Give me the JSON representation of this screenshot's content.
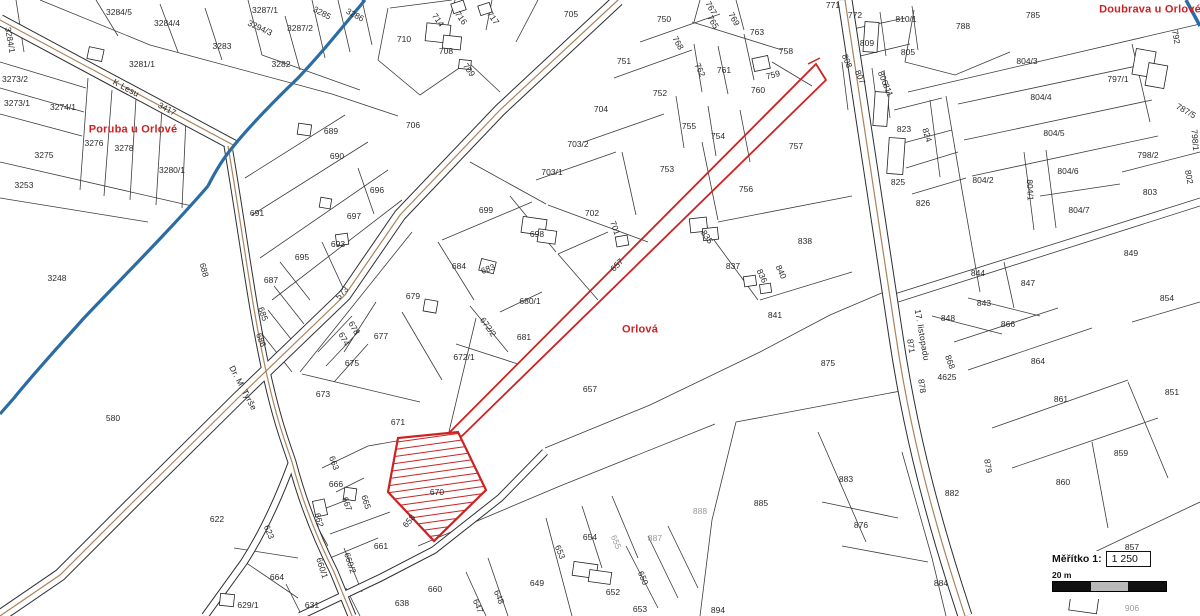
{
  "map": {
    "title": "cadastral-map",
    "highlight": {
      "hatched_parcel": "670",
      "color": "#cc2222"
    },
    "colors": {
      "parcel_line": "#3c3c3c",
      "stream": "#2b6ca3",
      "road_center": "#a9835c",
      "highlight": "#cc2222",
      "area_label": "#cc2222",
      "scale_bar_gray": "#b9b9b9"
    },
    "scale": {
      "label": "Měřítko  1:",
      "ratio": "1 250",
      "bar_label": "20 m"
    },
    "labels": [
      {
        "t": "Poruba u Orlové",
        "x": 133,
        "y": 130,
        "cls": "area"
      },
      {
        "t": "Orlová",
        "x": 640,
        "y": 330,
        "cls": "area"
      },
      {
        "t": "Doubrava u Orlové",
        "x": 1150,
        "y": 10,
        "cls": "area"
      },
      {
        "t": "K Lesu",
        "x": 126,
        "y": 88,
        "r": 28,
        "cls": "street"
      },
      {
        "t": "Dr. M. Tyrše",
        "x": 243,
        "y": 388,
        "r": 62,
        "cls": "street"
      },
      {
        "t": "17. listopadu",
        "x": 922,
        "y": 335,
        "r": 80,
        "cls": "street"
      },
      {
        "t": "3284/1",
        "x": 10,
        "y": 40,
        "r": 80
      },
      {
        "t": "3284/5",
        "x": 119,
        "y": 12
      },
      {
        "t": "3284/4",
        "x": 167,
        "y": 23
      },
      {
        "t": "3287/1",
        "x": 265,
        "y": 10
      },
      {
        "t": "3294/3",
        "x": 260,
        "y": 28,
        "r": 25
      },
      {
        "t": "3283",
        "x": 222,
        "y": 46
      },
      {
        "t": "3287/2",
        "x": 300,
        "y": 28
      },
      {
        "t": "3285",
        "x": 322,
        "y": 13,
        "r": 28
      },
      {
        "t": "3286",
        "x": 355,
        "y": 15,
        "r": 28
      },
      {
        "t": "3282",
        "x": 281,
        "y": 64
      },
      {
        "t": "3281/1",
        "x": 142,
        "y": 64
      },
      {
        "t": "3417",
        "x": 167,
        "y": 109,
        "r": 28
      },
      {
        "t": "3273/2",
        "x": 15,
        "y": 79
      },
      {
        "t": "3273/1",
        "x": 17,
        "y": 103
      },
      {
        "t": "3274/1",
        "x": 63,
        "y": 107
      },
      {
        "t": "3276",
        "x": 94,
        "y": 143
      },
      {
        "t": "3278",
        "x": 124,
        "y": 148
      },
      {
        "t": "3275",
        "x": 44,
        "y": 155
      },
      {
        "t": "3280/1",
        "x": 172,
        "y": 170
      },
      {
        "t": "3253",
        "x": 24,
        "y": 185
      },
      {
        "t": "3248",
        "x": 57,
        "y": 278
      },
      {
        "t": "580",
        "x": 113,
        "y": 418
      },
      {
        "t": "622",
        "x": 217,
        "y": 519
      },
      {
        "t": "691",
        "x": 257,
        "y": 213
      },
      {
        "t": "687",
        "x": 271,
        "y": 280
      },
      {
        "t": "685",
        "x": 263,
        "y": 314,
        "r": 70
      },
      {
        "t": "686",
        "x": 261,
        "y": 340,
        "r": 70
      },
      {
        "t": "688",
        "x": 204,
        "y": 270,
        "r": 75
      },
      {
        "t": "623",
        "x": 269,
        "y": 532,
        "r": 68
      },
      {
        "t": "689",
        "x": 331,
        "y": 131
      },
      {
        "t": "690",
        "x": 337,
        "y": 156
      },
      {
        "t": "696",
        "x": 377,
        "y": 190
      },
      {
        "t": "697",
        "x": 354,
        "y": 216
      },
      {
        "t": "693",
        "x": 338,
        "y": 244
      },
      {
        "t": "695",
        "x": 302,
        "y": 257
      },
      {
        "t": "706",
        "x": 413,
        "y": 125
      },
      {
        "t": "710",
        "x": 404,
        "y": 39
      },
      {
        "t": "708",
        "x": 446,
        "y": 51
      },
      {
        "t": "714",
        "x": 438,
        "y": 20,
        "r": 55
      },
      {
        "t": "716",
        "x": 461,
        "y": 18,
        "r": 55
      },
      {
        "t": "717",
        "x": 493,
        "y": 18,
        "r": 55
      },
      {
        "t": "709",
        "x": 469,
        "y": 70,
        "r": 55
      },
      {
        "t": "705",
        "x": 571,
        "y": 14
      },
      {
        "t": "750",
        "x": 664,
        "y": 19
      },
      {
        "t": "751",
        "x": 624,
        "y": 61
      },
      {
        "t": "752",
        "x": 660,
        "y": 93
      },
      {
        "t": "704",
        "x": 601,
        "y": 109
      },
      {
        "t": "703/2",
        "x": 578,
        "y": 144
      },
      {
        "t": "703/1",
        "x": 552,
        "y": 172
      },
      {
        "t": "753",
        "x": 667,
        "y": 169
      },
      {
        "t": "755",
        "x": 689,
        "y": 126
      },
      {
        "t": "754",
        "x": 718,
        "y": 136
      },
      {
        "t": "756",
        "x": 746,
        "y": 189
      },
      {
        "t": "757",
        "x": 796,
        "y": 146
      },
      {
        "t": "758",
        "x": 786,
        "y": 51
      },
      {
        "t": "759",
        "x": 773,
        "y": 75,
        "r": -15
      },
      {
        "t": "760",
        "x": 758,
        "y": 90
      },
      {
        "t": "761",
        "x": 724,
        "y": 70
      },
      {
        "t": "762",
        "x": 700,
        "y": 70,
        "r": 65
      },
      {
        "t": "763",
        "x": 757,
        "y": 32
      },
      {
        "t": "765",
        "x": 713,
        "y": 22,
        "r": 60
      },
      {
        "t": "767",
        "x": 711,
        "y": 8,
        "r": 60
      },
      {
        "t": "769",
        "x": 734,
        "y": 19,
        "r": 60
      },
      {
        "t": "768",
        "x": 678,
        "y": 43,
        "r": 60
      },
      {
        "t": "771",
        "x": 833,
        "y": 5
      },
      {
        "t": "772",
        "x": 855,
        "y": 15
      },
      {
        "t": "810/1",
        "x": 906,
        "y": 19
      },
      {
        "t": "809",
        "x": 867,
        "y": 43
      },
      {
        "t": "805",
        "x": 908,
        "y": 52
      },
      {
        "t": "808",
        "x": 847,
        "y": 61,
        "r": 68
      },
      {
        "t": "807",
        "x": 860,
        "y": 77,
        "r": 68
      },
      {
        "t": "806",
        "x": 883,
        "y": 78,
        "r": 68
      },
      {
        "t": "811",
        "x": 888,
        "y": 90,
        "r": 68
      },
      {
        "t": "823",
        "x": 904,
        "y": 129
      },
      {
        "t": "824",
        "x": 927,
        "y": 135,
        "r": 72
      },
      {
        "t": "825",
        "x": 898,
        "y": 182
      },
      {
        "t": "826",
        "x": 923,
        "y": 203
      },
      {
        "t": "788",
        "x": 963,
        "y": 26
      },
      {
        "t": "785",
        "x": 1033,
        "y": 15
      },
      {
        "t": "792",
        "x": 1176,
        "y": 37,
        "r": 80
      },
      {
        "t": "804/3",
        "x": 1027,
        "y": 61
      },
      {
        "t": "804/4",
        "x": 1041,
        "y": 97
      },
      {
        "t": "804/5",
        "x": 1054,
        "y": 133
      },
      {
        "t": "797/1",
        "x": 1118,
        "y": 79
      },
      {
        "t": "787/5",
        "x": 1186,
        "y": 111,
        "r": 30
      },
      {
        "t": "798/1",
        "x": 1195,
        "y": 140,
        "r": 85
      },
      {
        "t": "804/2",
        "x": 983,
        "y": 180
      },
      {
        "t": "804/6",
        "x": 1068,
        "y": 171
      },
      {
        "t": "804/1",
        "x": 1030,
        "y": 190,
        "r": 88
      },
      {
        "t": "804/7",
        "x": 1079,
        "y": 210
      },
      {
        "t": "798/2",
        "x": 1148,
        "y": 155
      },
      {
        "t": "803",
        "x": 1150,
        "y": 192
      },
      {
        "t": "802",
        "x": 1189,
        "y": 177,
        "r": 80
      },
      {
        "t": "849",
        "x": 1131,
        "y": 253
      },
      {
        "t": "844",
        "x": 978,
        "y": 273
      },
      {
        "t": "847",
        "x": 1028,
        "y": 283
      },
      {
        "t": "843",
        "x": 984,
        "y": 303
      },
      {
        "t": "848",
        "x": 948,
        "y": 318
      },
      {
        "t": "854",
        "x": 1167,
        "y": 298
      },
      {
        "t": "851",
        "x": 1172,
        "y": 392
      },
      {
        "t": "866",
        "x": 1008,
        "y": 324
      },
      {
        "t": "864",
        "x": 1038,
        "y": 361
      },
      {
        "t": "861",
        "x": 1061,
        "y": 399
      },
      {
        "t": "859",
        "x": 1121,
        "y": 453
      },
      {
        "t": "860",
        "x": 1063,
        "y": 482
      },
      {
        "t": "857",
        "x": 1132,
        "y": 547
      },
      {
        "t": "871",
        "x": 911,
        "y": 346,
        "r": 82
      },
      {
        "t": "868",
        "x": 950,
        "y": 362,
        "r": 70
      },
      {
        "t": "4625",
        "x": 947,
        "y": 377
      },
      {
        "t": "878",
        "x": 922,
        "y": 386,
        "r": 82
      },
      {
        "t": "879",
        "x": 988,
        "y": 466,
        "r": 82
      },
      {
        "t": "875",
        "x": 828,
        "y": 363
      },
      {
        "t": "838",
        "x": 805,
        "y": 241
      },
      {
        "t": "837",
        "x": 733,
        "y": 266
      },
      {
        "t": "836",
        "x": 762,
        "y": 276,
        "r": 65
      },
      {
        "t": "840",
        "x": 781,
        "y": 272,
        "r": 65
      },
      {
        "t": "841",
        "x": 775,
        "y": 315
      },
      {
        "t": "835",
        "x": 707,
        "y": 237,
        "r": 55
      },
      {
        "t": "702",
        "x": 592,
        "y": 213
      },
      {
        "t": "701",
        "x": 615,
        "y": 228,
        "r": 70
      },
      {
        "t": "699",
        "x": 486,
        "y": 210
      },
      {
        "t": "698",
        "x": 537,
        "y": 234
      },
      {
        "t": "684",
        "x": 459,
        "y": 266
      },
      {
        "t": "683",
        "x": 488,
        "y": 269,
        "r": -20
      },
      {
        "t": "680/1",
        "x": 530,
        "y": 301
      },
      {
        "t": "672/2",
        "x": 488,
        "y": 327,
        "r": 55
      },
      {
        "t": "681",
        "x": 524,
        "y": 337
      },
      {
        "t": "672/1",
        "x": 464,
        "y": 357
      },
      {
        "t": "677",
        "x": 381,
        "y": 336
      },
      {
        "t": "678",
        "x": 354,
        "y": 328,
        "r": 60
      },
      {
        "t": "674",
        "x": 344,
        "y": 339,
        "r": 60
      },
      {
        "t": "675",
        "x": 352,
        "y": 363
      },
      {
        "t": "673",
        "x": 323,
        "y": 394
      },
      {
        "t": "679",
        "x": 413,
        "y": 296
      },
      {
        "t": "573",
        "x": 342,
        "y": 293,
        "r": -48
      },
      {
        "t": "671",
        "x": 398,
        "y": 422
      },
      {
        "t": "657",
        "x": 617,
        "y": 265,
        "r": -46
      },
      {
        "t": "657",
        "x": 590,
        "y": 389
      },
      {
        "t": "885",
        "x": 761,
        "y": 503
      },
      {
        "t": "883",
        "x": 846,
        "y": 479
      },
      {
        "t": "876",
        "x": 861,
        "y": 525
      },
      {
        "t": "882",
        "x": 952,
        "y": 493
      },
      {
        "t": "884",
        "x": 941,
        "y": 583
      },
      {
        "t": "888",
        "x": 700,
        "y": 511,
        "cls": "gray"
      },
      {
        "t": "887",
        "x": 655,
        "y": 538,
        "cls": "gray"
      },
      {
        "t": "654",
        "x": 590,
        "y": 537
      },
      {
        "t": "655",
        "x": 616,
        "y": 542,
        "r": 68,
        "cls": "gray"
      },
      {
        "t": "653",
        "x": 560,
        "y": 552,
        "r": 68
      },
      {
        "t": "652",
        "x": 613,
        "y": 592
      },
      {
        "t": "650",
        "x": 643,
        "y": 578,
        "r": 68
      },
      {
        "t": "653",
        "x": 640,
        "y": 609
      },
      {
        "t": "894",
        "x": 718,
        "y": 610
      },
      {
        "t": "649",
        "x": 537,
        "y": 583
      },
      {
        "t": "648",
        "x": 499,
        "y": 597,
        "r": 68
      },
      {
        "t": "647",
        "x": 478,
        "y": 606,
        "r": 68
      },
      {
        "t": "660",
        "x": 435,
        "y": 589
      },
      {
        "t": "638",
        "x": 402,
        "y": 603
      },
      {
        "t": "631",
        "x": 312,
        "y": 605
      },
      {
        "t": "629/1",
        "x": 248,
        "y": 605
      },
      {
        "t": "664",
        "x": 277,
        "y": 577
      },
      {
        "t": "661",
        "x": 381,
        "y": 546
      },
      {
        "t": "660/1",
        "x": 322,
        "y": 568,
        "r": 72
      },
      {
        "t": "660/2",
        "x": 350,
        "y": 563,
        "r": 72
      },
      {
        "t": "662",
        "x": 319,
        "y": 520,
        "r": 75
      },
      {
        "t": "665",
        "x": 366,
        "y": 502,
        "r": 72
      },
      {
        "t": "667",
        "x": 347,
        "y": 504,
        "r": 70
      },
      {
        "t": "666",
        "x": 336,
        "y": 484
      },
      {
        "t": "663",
        "x": 334,
        "y": 463,
        "r": 70
      },
      {
        "t": "670",
        "x": 437,
        "y": 492
      },
      {
        "t": "658",
        "x": 409,
        "y": 521,
        "r": -50
      },
      {
        "t": "906",
        "x": 1132,
        "y": 608,
        "cls": "gray"
      }
    ]
  }
}
